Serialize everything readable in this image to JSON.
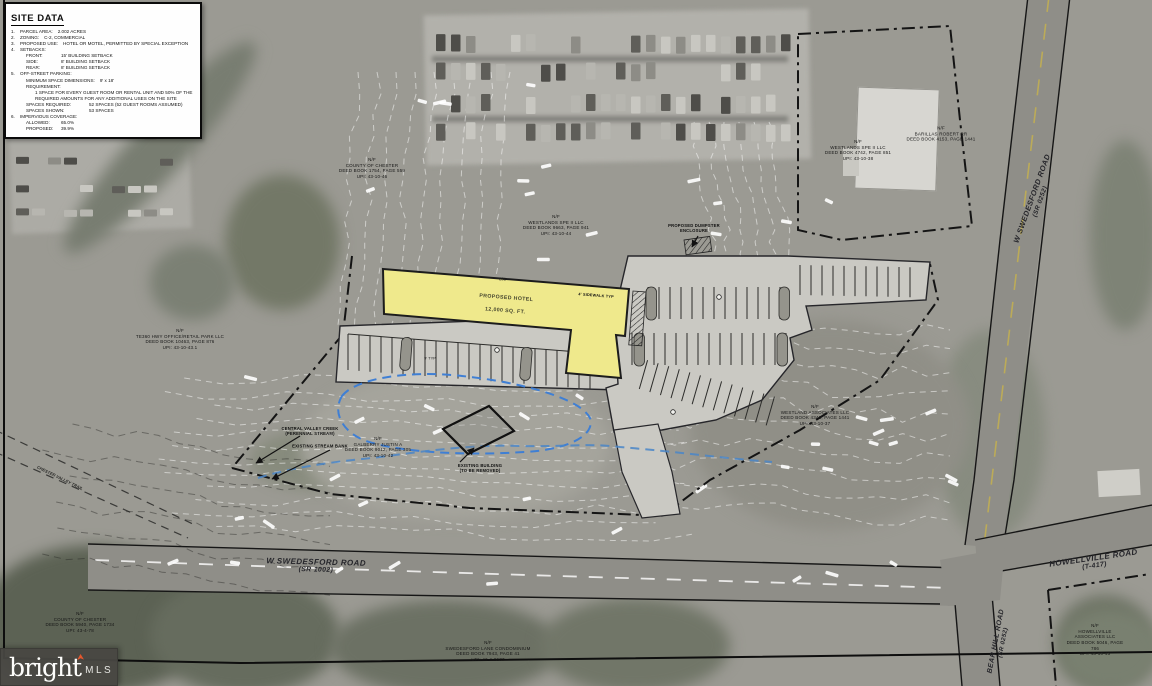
{
  "site_data": {
    "title": "SITE DATA",
    "lines": [
      {
        "n": "1.",
        "k": "PARCEL AREA:",
        "v": "2.002 ACRES"
      },
      {
        "n": "2.",
        "k": "ZONING:",
        "v": "C-2, COMMERCIAL"
      },
      {
        "n": "3.",
        "k": "PROPOSED USE:",
        "v": "HOTEL OR MOTEL, PERMITTED BY SPECIAL EXCEPTION"
      },
      {
        "n": "4.",
        "k": "SETBACKS:",
        "v": ""
      },
      {
        "n": "",
        "k": "FRONT:",
        "v": "15' BUILDING SETBACK"
      },
      {
        "n": "",
        "k": "SIDE:",
        "v": "8' BUILDING SETBACK"
      },
      {
        "n": "",
        "k": "REAR:",
        "v": "8' BUILDING SETBACK"
      },
      {
        "n": "5.",
        "k": "OFF-STREET PARKING:",
        "v": ""
      },
      {
        "n": "",
        "k": "MINIMUM SPACE DIMENSIONS:",
        "v": "9' x 18'"
      },
      {
        "n": "",
        "k": "REQUIREMENT:",
        "v": ""
      },
      {
        "n": "",
        "k": "",
        "v": "1 SPACE FOR EVERY GUEST ROOM OR RENTAL UNIT AND 50% OF THE REQUIRED AMOUNTS FOR ANY ADDITIONAL USES ON THE SITE"
      },
      {
        "n": "",
        "k": "SPACES REQUIRED:",
        "v": "52 SPACES (52 GUEST ROOMS ASSUMED)"
      },
      {
        "n": "",
        "k": "SPACES SHOWN:",
        "v": "53 SPACES"
      },
      {
        "n": "6.",
        "k": "IMPERVIOUS COVERAGE:",
        "v": ""
      },
      {
        "n": "",
        "k": "ALLOWED:",
        "v": "65.0%"
      },
      {
        "n": "",
        "k": "PROPOSED:",
        "v": "39.9%"
      }
    ]
  },
  "building": {
    "name": "PROPOSED HOTEL",
    "area": "12,000 SQ. FT."
  },
  "dimensions": {
    "building_length": "250'",
    "stall": "9' TYP"
  },
  "roads": {
    "swedesford_main": {
      "name": "W SWEDESFORD ROAD",
      "ref": "(SR 1002)"
    },
    "swedesford_north": {
      "name": "W SWEDESFORD ROAD",
      "ref": "(SR 0252)"
    },
    "howellville": {
      "name": "HOWELLVILLE ROAD",
      "ref": "(T-417)"
    },
    "bear_hill": {
      "name": "BEAR HILL ROAD",
      "ref": "(SR 0252)"
    },
    "trail": {
      "name": "CHESTER VALLEY TRAIL"
    }
  },
  "annotations": {
    "creek": "CENTRAL VALLEY CREEK\n(PERENNIAL STREAM)",
    "stream_bank": "EXISTING STREAM BANK",
    "existing_building": "EXISTING BUILDING\n(TO BE REMOVED)",
    "sidewalk": "4' SIDEWALK TYP",
    "dumpster": "PROPOSED DUMPSTER\nENCLOSURE"
  },
  "parcels": [
    {
      "text": "N/F\nCOUNTY OF CHESTER\nDEED BOOK 1754, PAGE 559\nUPI: 43-10-46"
    },
    {
      "text": "N/F\nWESTLANDS SPE II LLC\nDEED BOOK 9663, PAGE 941\nUPI: 43-10-44"
    },
    {
      "text": "N/F\nWESTLANDS SPE II LLC\nDEED BOOK 4742, PAGE 851\nUPI: 43-10-38"
    },
    {
      "text": "N/F\nBARILLAS ROBERT RR\nDEED BOOK 4153, PAGE 1441"
    },
    {
      "text": "N/F\nTE360 HWY OFFICE/RETAIL PARK LLC\nDEED BOOK 10463, PAGE 876\nUPI: 43-10-43.1"
    },
    {
      "text": "N/F\nWESTLAND ASSOCIATES LLC\nDEED BOOK 4342, PAGE 1441\nUPI: 43-10-37"
    },
    {
      "text": "N/F\nCOUNTY OF CHESTER\nDEED BOOK 5940, PAGE 1734\nUPI: 43-4-78"
    },
    {
      "text": "N/F\nSWEDESFORD LANE CONDOMINIUM\nDEED BOOK 7943, PAGE 41\nUPI: 43-4-8677"
    },
    {
      "text": "N/F\nHOWELLVILLE ASSOCIATES LLC\nDEED BOOK 5046, PAGE 786\nUPI: 43-10-45"
    },
    {
      "text": "N/F\nGALBERRY JUSTIN A\nDEED BOOK 9012, PAGE 305\nUPI: 43-10-42"
    }
  ],
  "watermark": {
    "brand": "bright",
    "suffix": "MLS"
  },
  "colors": {
    "building": "#efe98c",
    "floodplain": "#3f7fd4",
    "stream": "#4a86c8",
    "parking": "#cac9c3"
  }
}
